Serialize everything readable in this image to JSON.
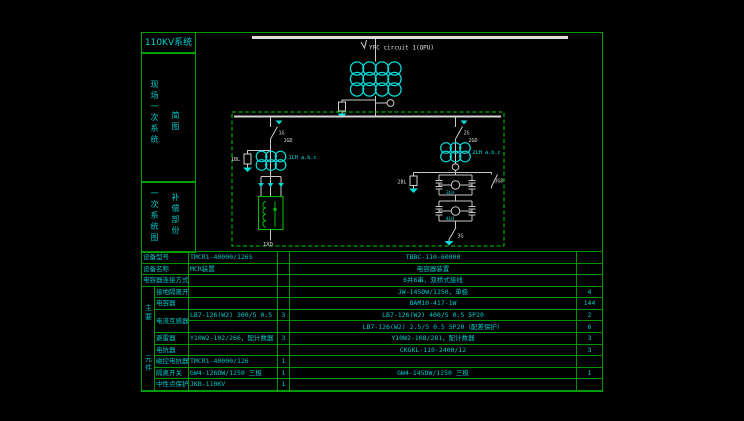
{
  "colors": {
    "background": "#000000",
    "frame_green": "#00a000",
    "table_line_green": "#009400",
    "text_cyan": "#00cccc",
    "diagram_line_white": "#c9c9c9",
    "symbol_cyan": "#00dede",
    "reactor_green": "#00bb00",
    "dashed_box_green": "#00cf00"
  },
  "sidebar": {
    "title": "110KV系统",
    "section1": {
      "col1": "现场一次系统",
      "col2": "简图"
    },
    "section2": {
      "col1": "一次系统图",
      "col2": "补偿部份"
    }
  },
  "diagram": {
    "labels": {
      "feeder": "YPC circuit 1(QPU)",
      "g1": "1G",
      "gd1": "1GD",
      "bl1": "1BL",
      "ct1": "1LH a.b.c",
      "xd": "1XD",
      "g2": "2G",
      "gd2": "2GD",
      "bl2": "2BL",
      "ct2": "2LH a.b.c",
      "bridge_ct1": "3LH",
      "bridge_ct2": "4LH",
      "gd3": "3GD",
      "g3": "3G"
    }
  },
  "table": {
    "group_label_top": "主要",
    "group_label_bottom": "元件",
    "rows": [
      {
        "label": "设备型号",
        "left_model": "TMCR1-40000/126S",
        "left_qty": "",
        "right_model": "TBBC-110-60000",
        "right_qty": ""
      },
      {
        "label": "设备名称",
        "left_model": "MCR装置",
        "left_qty": "",
        "right_model": "电容器装置",
        "right_qty": ""
      },
      {
        "label": "电容器连接方式",
        "left_model": "",
        "left_qty": "",
        "right_model": "6并6串，双桥式接线",
        "right_qty": ""
      },
      {
        "label": "接地隔离开关",
        "left_model": "",
        "left_qty": "",
        "right_model": "JW-145DW/1250，单极",
        "right_qty": "4"
      },
      {
        "label": "电容器",
        "left_model": "",
        "left_qty": "",
        "right_model": "BAM10-417-1W",
        "right_qty": "144"
      },
      {
        "label": "电流互感器",
        "left_model": "LB7-126(W2) 300/5 0.5 5P20",
        "left_qty": "3",
        "right_model": "LB7-126(W2) 400/5 0.5 5P20",
        "right_qty": "2"
      },
      {
        "label": "",
        "left_model": "",
        "left_qty": "",
        "right_model": "LB7-126(W2) 2.5/5 0.5 5P20（配差保护）",
        "right_qty": "6"
      },
      {
        "label": "避雷器",
        "left_model": "Y10W2-102/266，配计数器",
        "left_qty": "3",
        "right_model": "Y10W2-108/281，配计数器",
        "right_qty": "3"
      },
      {
        "label": "电抗器",
        "left_model": "",
        "left_qty": "",
        "right_model": "CKGKL-110-2400/12",
        "right_qty": "3"
      },
      {
        "label": "磁控电抗器",
        "left_model": "TMCR1-40000/126",
        "left_qty": "1",
        "right_model": "",
        "right_qty": ""
      },
      {
        "label": "隔离开关",
        "left_model": "GW4-126DW/1250 三极",
        "left_qty": "1",
        "right_model": "GW4-145DW/1250 三极",
        "right_qty": "1"
      },
      {
        "label": "中性点保护装置",
        "left_model": "JKB-110KV",
        "left_qty": "1",
        "right_model": "",
        "right_qty": ""
      }
    ]
  }
}
